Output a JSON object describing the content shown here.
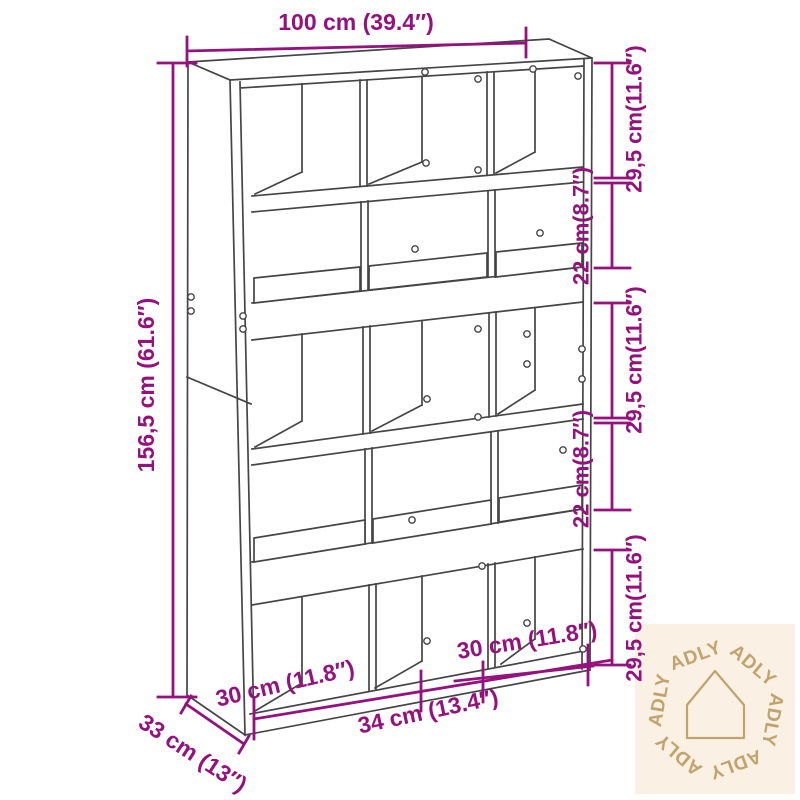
{
  "dimensions": {
    "width_top": "100 cm (39.4″)",
    "height_left": "156,5 cm (61.6″)",
    "right": [
      {
        "label": "29,5 cm(11.6″)"
      },
      {
        "label": "22 cm(8.7″)"
      },
      {
        "label": "29,5 cm(11.6″)"
      },
      {
        "label": "22 cm(8.7″)"
      },
      {
        "label": "29,5 cm(11.6″)"
      }
    ],
    "depth": "33 cm (13″)",
    "bottom_left_compartment": "30 cm (11.8″)",
    "bottom_right_compartment": "30 cm (11.8″)",
    "bottom_middle_compartment": "34 cm (13.4″)"
  },
  "watermark": {
    "brand": "ADLY"
  },
  "colors": {
    "dimension": "#95117e",
    "cabinet_line": "#454545",
    "watermark_bg": "#faf0e3",
    "watermark_fg": "#c2a36d"
  }
}
